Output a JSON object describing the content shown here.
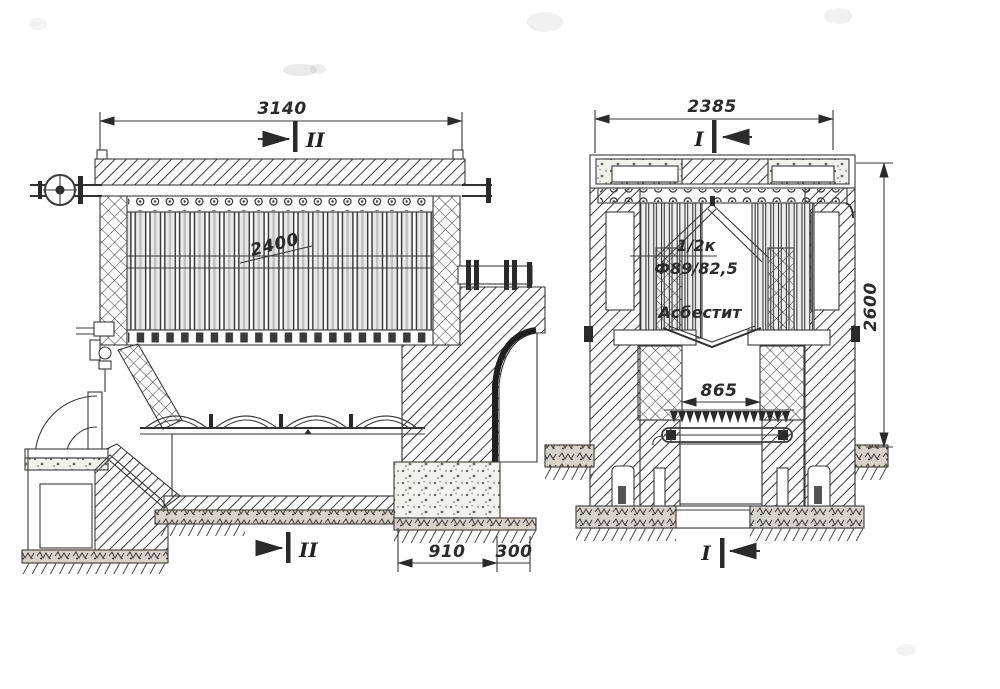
{
  "left_view": {
    "name": "longitudinal-section",
    "dim_width_top": "3140",
    "dim_tube_length": "2400",
    "dim_foundation_left": "910",
    "dim_foundation_right": "300",
    "section_mark_top": "II",
    "section_mark_bottom": "II"
  },
  "right_view": {
    "name": "cross-section",
    "dim_width_top": "2385",
    "dim_height": "2600",
    "dim_grate_width": "865",
    "tube_count_note": "1/2к",
    "tube_size_note": "Ф89/82,5",
    "insulation_label": "Асбестит",
    "section_mark_top": "I",
    "section_mark_bottom": "I"
  },
  "ink_color": "#2f2f2f",
  "paper_color": "#ffffff"
}
